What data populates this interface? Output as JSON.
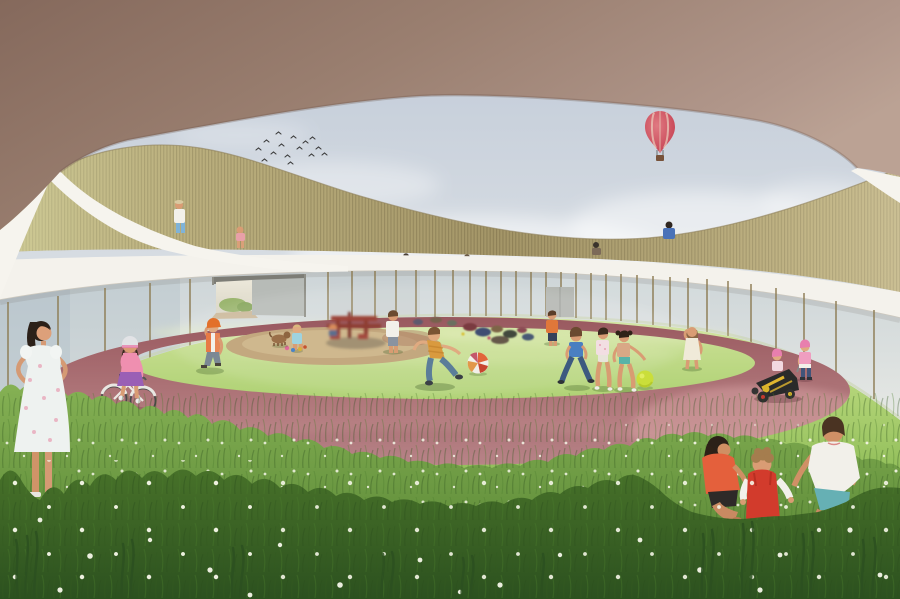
{
  "scene": {
    "description": "Architectural rendering of a ring-shaped kindergarten: children play on a grassy circular courtyard with a red oval running track, enclosed by a glass facade with wooden-slat roof parapet; an oval opening in the roof reveals sky, a flock of birds and a red hot air balloon.",
    "objects": {
      "sky": "sky seen through oval roof opening",
      "clouds": "soft white clouds",
      "birds": "flock of birds",
      "balloon": "red hot air balloon with basket",
      "roof": "curved roof underside with oval opening",
      "parapet": "wooden slat parapet on roof terrace",
      "fascia": "white fascia band above glass facade",
      "glass": "circular glass curtain wall with bronze mullions",
      "passage": "open passage through the building",
      "track": "red oval running track",
      "sand": "sand play circle",
      "carousel": "spinning red playground carousel",
      "toys": "scattered toys and bags on the lawn",
      "lawn": "sunlit courtyard lawn",
      "meadow": "tall foreground grass with white flowers",
      "girl_standing": "girl in white floral dress, hands on hips",
      "girl_bike": "girl in pink riding a bicycle on the track",
      "boy_cap": "child with orange cap walking",
      "toddler_sand": "toddler playing beside the sand circle",
      "dog": "small dog on the sand",
      "kid_white": "child in white t-shirt",
      "boy_kick": "boy kicking a beach ball",
      "beach_ball": "striped beach ball",
      "boy_far": "boy in orange shirt",
      "trio": "three children chasing a yellow ball",
      "ball_yellow": "yellow-green ball",
      "girl_right": "girl in light dress",
      "gokart": "black and yellow soapbox kart with two toddlers",
      "group_grass": "teen and two children crouching in the tall grass",
      "roof_people": "children on the roof terrace"
    }
  },
  "colors": {
    "sky-top": "#bfc9d7",
    "sky-bottom": "#e0e4e7",
    "cloud": "#ffffff",
    "roof-dark": "#85695c",
    "roof-mid": "#9a7f70",
    "roof-light": "#bba294",
    "rim": "#f6f4ee",
    "fascia": "#f4f2ec",
    "fascia-shadow": "#c9c3b8",
    "slat-base": "#b3a575",
    "slat-dark": "#8f825a",
    "slat-light": "#d6d4a8",
    "glass-top": "#cdd5d8",
    "glass-bottom": "#e6e8e4",
    "glass-left": "#a9bac4",
    "mullion": "#8d7d55",
    "passage-light": "#ece8da",
    "wall-grey": "#b7bbb7",
    "door-grey": "#b4b7b2",
    "grass-far": "#cfe29a",
    "grass-mid": "#8cbb55",
    "grass-fore": "#507e2f",
    "grass-front": "#2c511f",
    "flower": "#f4f5e6",
    "track-dark": "#99595f",
    "track-light": "#c79598",
    "track-pink": "#d8a3a4",
    "sand": "#c3a87f",
    "sand-light": "#d2bb92",
    "carousel-red": "#9c4237",
    "balloon-red": "#c23a4c",
    "balloon-light": "#e07a82",
    "basket": "#77523a",
    "bird": "#3c3c3c",
    "skin": "#d99c74",
    "skin-light": "#e0aa80",
    "hair-dark": "#2b2018",
    "hair-brown": "#6b4a30",
    "white-cloth": "#f2f0ea",
    "denim": "#5b7d99",
    "navy": "#35415a",
    "orange": "#e0773a",
    "mustard": "#d99a3e",
    "cap-orange": "#e2702a",
    "pink": "#ef8fb0",
    "pink-cap": "#e87fae",
    "violet": "#9a5fb5",
    "blue": "#4a7fc1",
    "jeans": "#3d5a80",
    "light-blue": "#9fd3df",
    "teal": "#58b3a8",
    "teal-shorts": "#66b0b4",
    "coral": "#e4603c",
    "red": "#d23b2c",
    "ball-yellow": "#cade3a",
    "beach-orange": "#e2653a",
    "beach-red": "#c8452f",
    "kart-black": "#2a2a2a",
    "kart-yellow": "#e0b52f"
  }
}
